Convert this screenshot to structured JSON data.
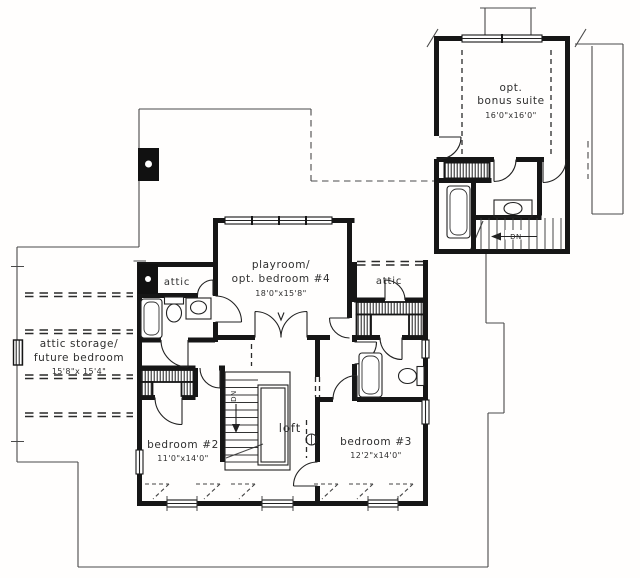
{
  "drawing": {
    "kind": "architectural floor plan - upper level",
    "background": "#fffefd",
    "ink": "#161616",
    "text_color": "#2e2e2e"
  },
  "rooms": {
    "bonus_suite": {
      "line1": "opt.",
      "line2": "bonus suite",
      "dims": "16'0\"x16'0\""
    },
    "playroom": {
      "line1": "playroom/",
      "line2": "opt. bedroom #4",
      "dims": "18'0\"x15'8\""
    },
    "attic_left": {
      "label": "attic"
    },
    "attic_right": {
      "label": "attic"
    },
    "attic_storage": {
      "line1": "attic storage/",
      "line2": "future bedroom",
      "dims": "15'8\"x 15'4\""
    },
    "bedroom_2": {
      "label": "bedroom #2",
      "dims": "11'0\"x14'0\""
    },
    "loft": {
      "label": "loft"
    },
    "bedroom_3": {
      "label": "bedroom #3",
      "dims": "12'2\"x14'0\""
    }
  },
  "stairs": {
    "main_down_label": "DN",
    "bonus_down_label": "DN"
  }
}
